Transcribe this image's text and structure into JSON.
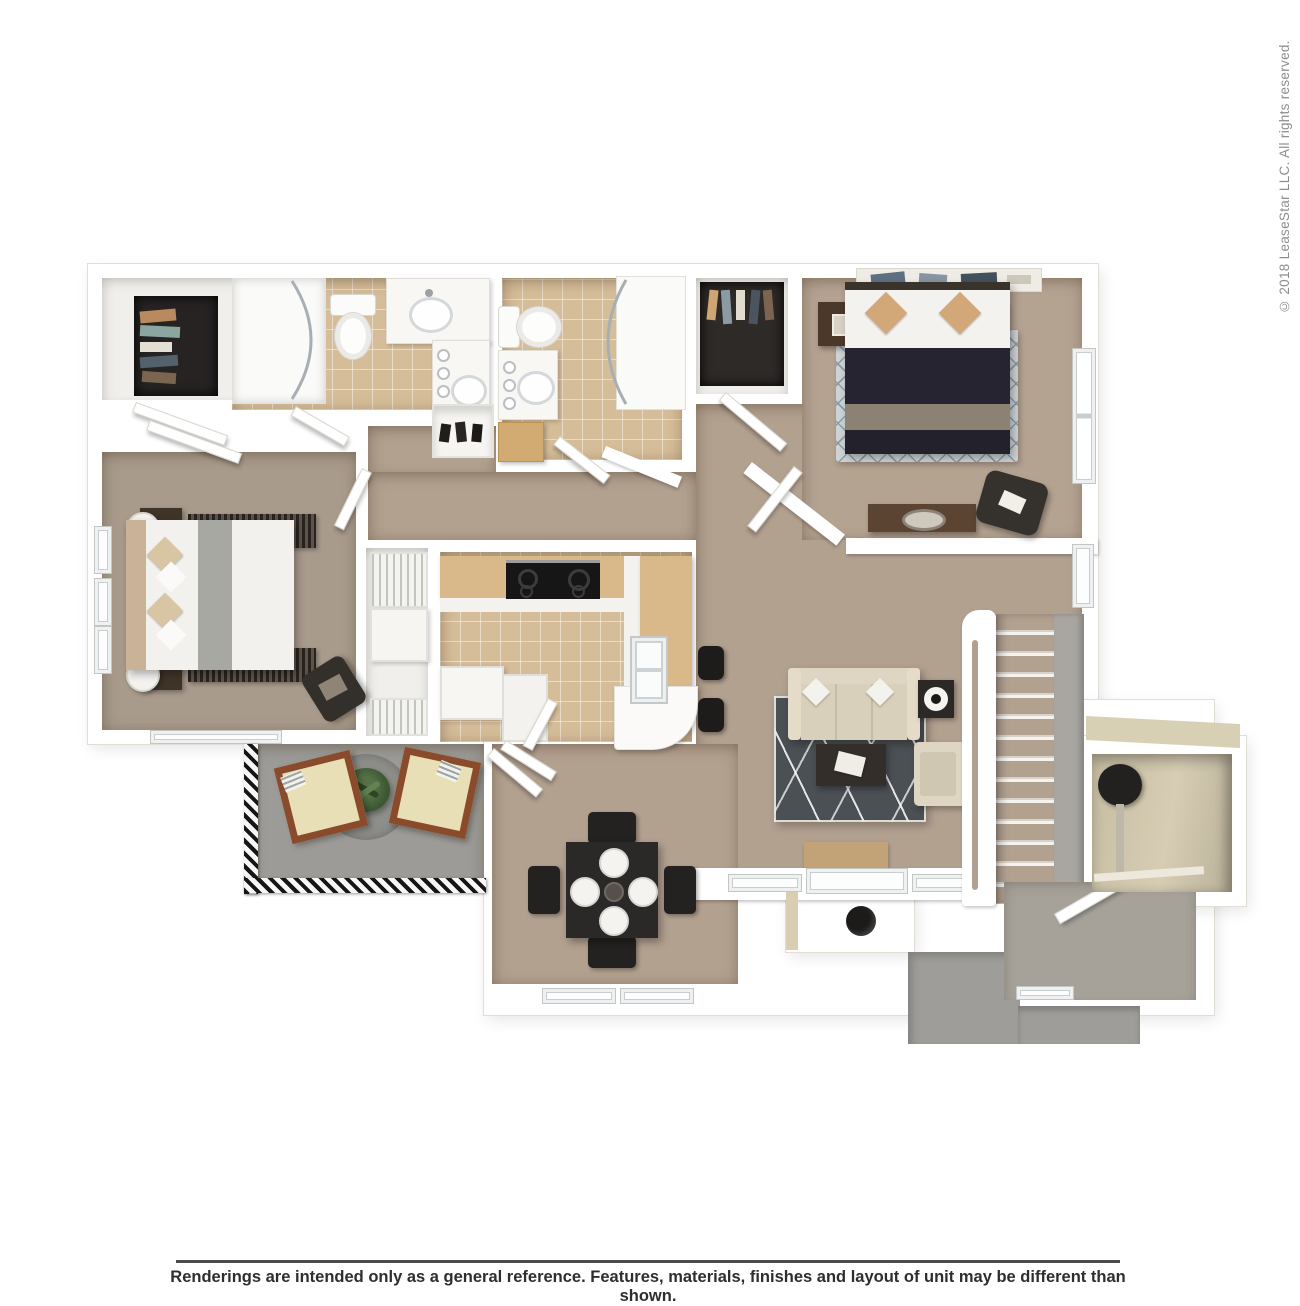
{
  "watermark": {
    "copyright": "© 2018 LeaseStar LLC. All rights reserved."
  },
  "footer": {
    "disclaimer": "Renderings are intended only as a general reference. Features, materials, finishes and layout of unit may be different than shown."
  },
  "colors": {
    "page": "#ffffff",
    "wall": "#ffffff",
    "wall-edge": "#e2ded6",
    "white-floor": "#f1efec",
    "carpet": "#b3a190",
    "carpet-master": "#a99b8c",
    "carpet-bed2": "#b5a392",
    "tile": "#d6bd99",
    "patio": "#9c9b97",
    "walkway": "#9e9d99",
    "foyer-floor": "#a6a29a",
    "storage-beige": "#cfc7ae",
    "rug-dark": "#4b5054",
    "rug-light": "#ced3d5",
    "wood-counter": "#d9b88a",
    "wood-dark": "#5c4433",
    "brown-night": "#4a382a",
    "navy-bed": "#262430",
    "cream-sofa": "#ded6c2",
    "tan-mat": "#c2a277",
    "chair-wood": "#8a4a2c",
    "chair-cushion": "#e9dfb6",
    "dark-furniture": "#2b2825",
    "plant-green": "#3f5c35",
    "stove-black": "#161616",
    "grass-wallface": "#a9a6a2"
  }
}
